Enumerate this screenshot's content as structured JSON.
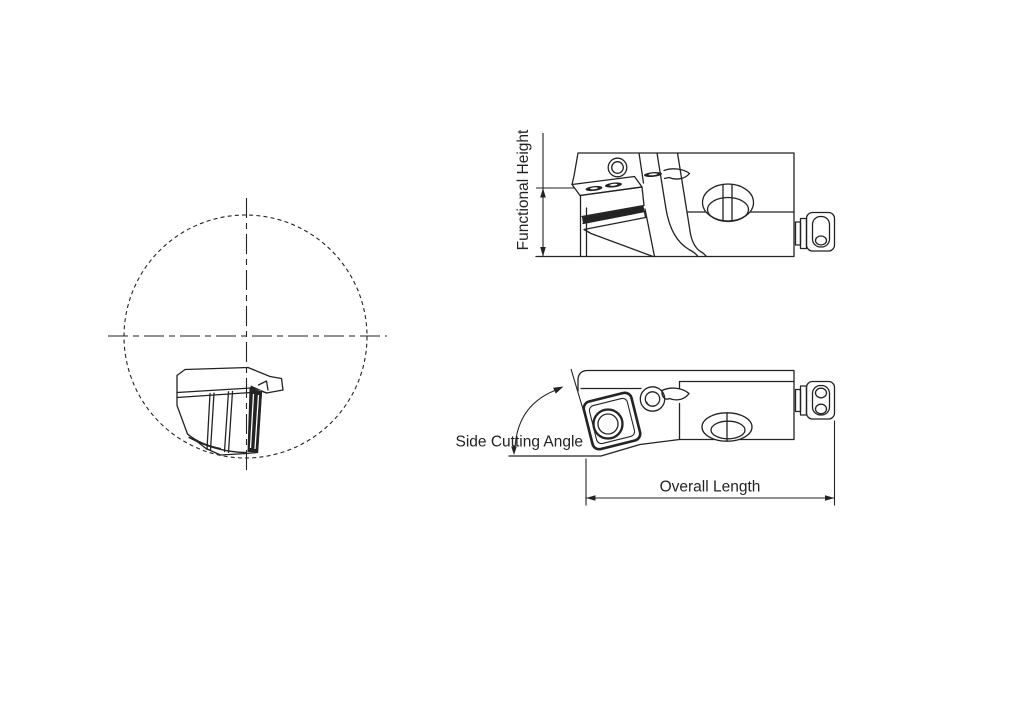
{
  "canvas": {
    "width": 1024,
    "height": 724,
    "background": "#ffffff",
    "line_color": "#232323"
  },
  "annotations": {
    "functional_height": {
      "label": "Functional Height"
    },
    "side_cutting_angle": {
      "label": "Side Cutting Angle"
    },
    "overall_length": {
      "label": "Overall Length"
    }
  }
}
